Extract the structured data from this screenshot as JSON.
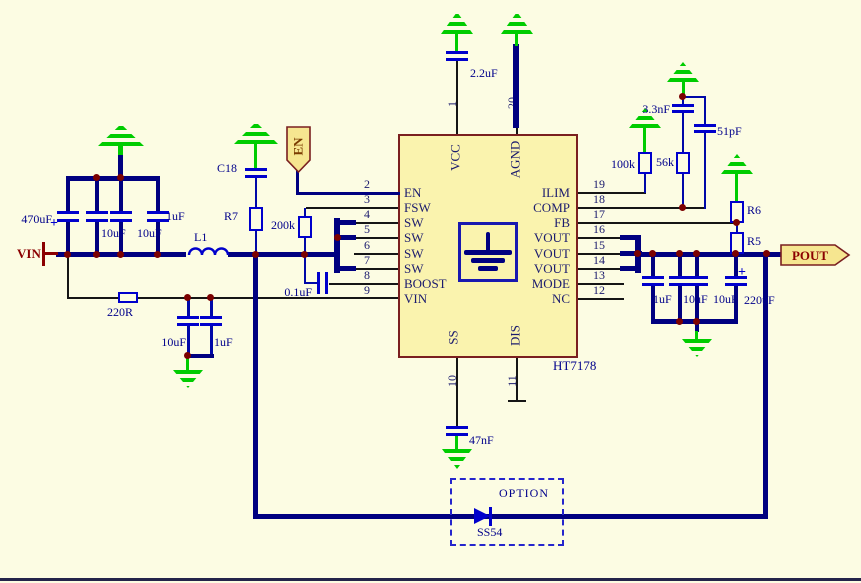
{
  "schematic": {
    "ic": {
      "part": "HT7178",
      "left_pins": [
        {
          "num": "2",
          "label": "EN"
        },
        {
          "num": "3",
          "label": "FSW"
        },
        {
          "num": "4",
          "label": "SW"
        },
        {
          "num": "5",
          "label": "SW"
        },
        {
          "num": "6",
          "label": "SW"
        },
        {
          "num": "7",
          "label": "SW"
        },
        {
          "num": "8",
          "label": "BOOST"
        },
        {
          "num": "9",
          "label": "VIN"
        }
      ],
      "right_pins": [
        {
          "num": "19",
          "label": "ILIM"
        },
        {
          "num": "18",
          "label": "COMP"
        },
        {
          "num": "17",
          "label": "FB"
        },
        {
          "num": "16",
          "label": "VOUT"
        },
        {
          "num": "15",
          "label": "VOUT"
        },
        {
          "num": "14",
          "label": "VOUT"
        },
        {
          "num": "13",
          "label": "MODE"
        },
        {
          "num": "12",
          "label": "NC"
        }
      ],
      "top_pins": [
        {
          "num": "1",
          "label": "VCC"
        },
        {
          "num": "20",
          "label": "AGND"
        }
      ],
      "bottom_pins": [
        {
          "num": "10",
          "label": "SS"
        },
        {
          "num": "11",
          "label": "DIS"
        }
      ]
    },
    "ports": {
      "vin": "VIN",
      "pout": "POUT",
      "en": "EN"
    },
    "values": {
      "c_in_bulk": "470uF",
      "c_in_1": "10uF",
      "c_in_2": "10uF",
      "c_in_3": "1uF",
      "plus": "+",
      "l1": "L1",
      "c18": "C18",
      "r7": "R7",
      "r_fsw": "200k",
      "c_boost": "0.1uF",
      "r_vin": "220R",
      "c_vin_1": "10uF",
      "c_vin_2": "1uF",
      "c_vcc": "2.2uF",
      "r_ilim": "100k",
      "c_comp_1": "3.3nF",
      "r_comp": "56k",
      "c_comp_2": "51pF",
      "r6": "R6",
      "r5": "R5",
      "c_out_1": "1uF",
      "c_out_2": "10uF",
      "c_out_3": "10uF",
      "c_out_4": "220uF",
      "c_ss": "47nF",
      "option": "OPTION",
      "diode": "SS54"
    },
    "colors": {
      "background": "#FCFCE3",
      "bus_wire": "#000080",
      "component": "#0000CC",
      "ground": "#00CC00",
      "junction": "#7B0101",
      "port_text": "#8B0000",
      "label_text": "#00008B",
      "ic_fill": "#FAF3AE",
      "ic_border": "#7A1F1F",
      "flag_fill": "#F6E690"
    }
  }
}
